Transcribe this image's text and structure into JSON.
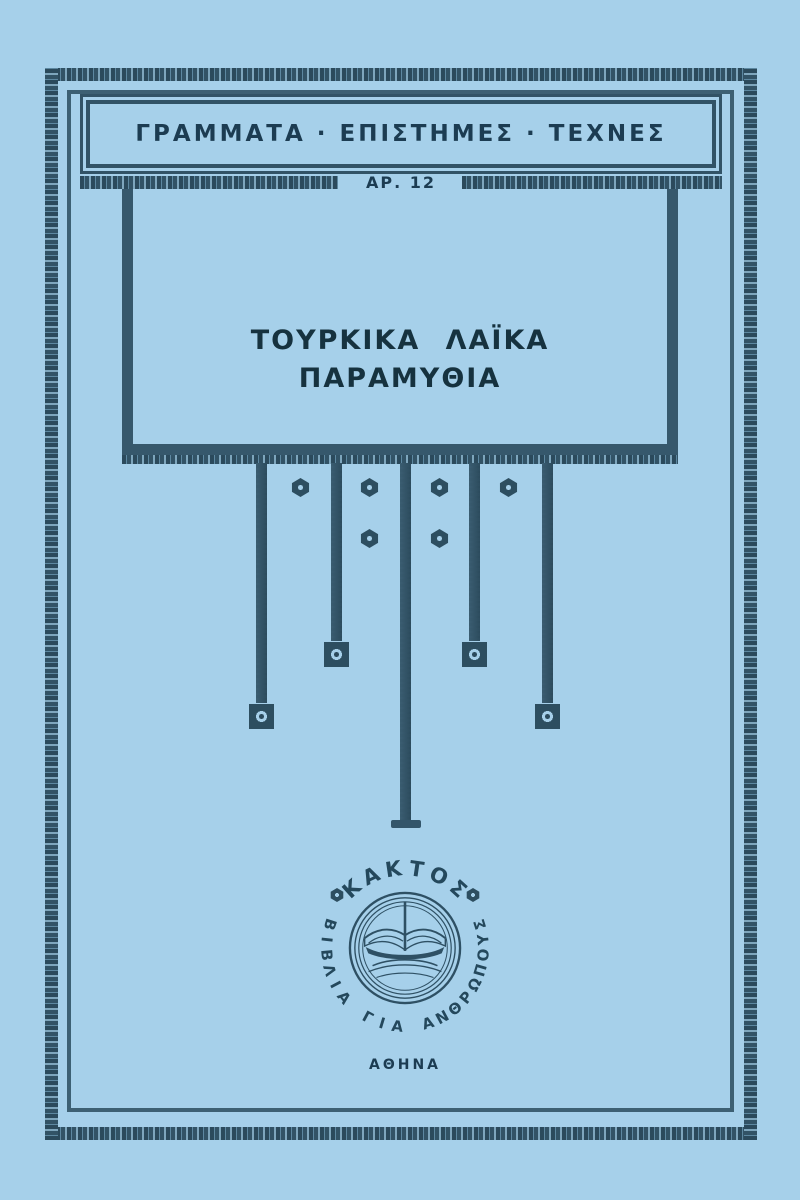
{
  "cover": {
    "series_banner": "ΓΡΑΜΜΑΤΑ · ΕΠΙΣΤΗΜΕΣ · ΤΕΧΝΕΣ",
    "series_number": "ΑΡ. 12",
    "title_line1": "ΤΟΥΡΚΙΚΑ ΛΑΪΚΑ",
    "title_line2": "ΠΑΡΑΜΥΘΙΑ",
    "publisher_logo": {
      "top_arc_text": "ΚΑΚΤΟΣ",
      "bottom_arc_text": "ΒΙΒΛΙΑ ΓΙΑ ΑΝΘΡΩΠΟΥΣ"
    },
    "city": "ΑΘΗΝΑ",
    "colors": {
      "background": "#a6d0ea",
      "ink": "#2d4e60",
      "text": "#1c3c52"
    }
  }
}
